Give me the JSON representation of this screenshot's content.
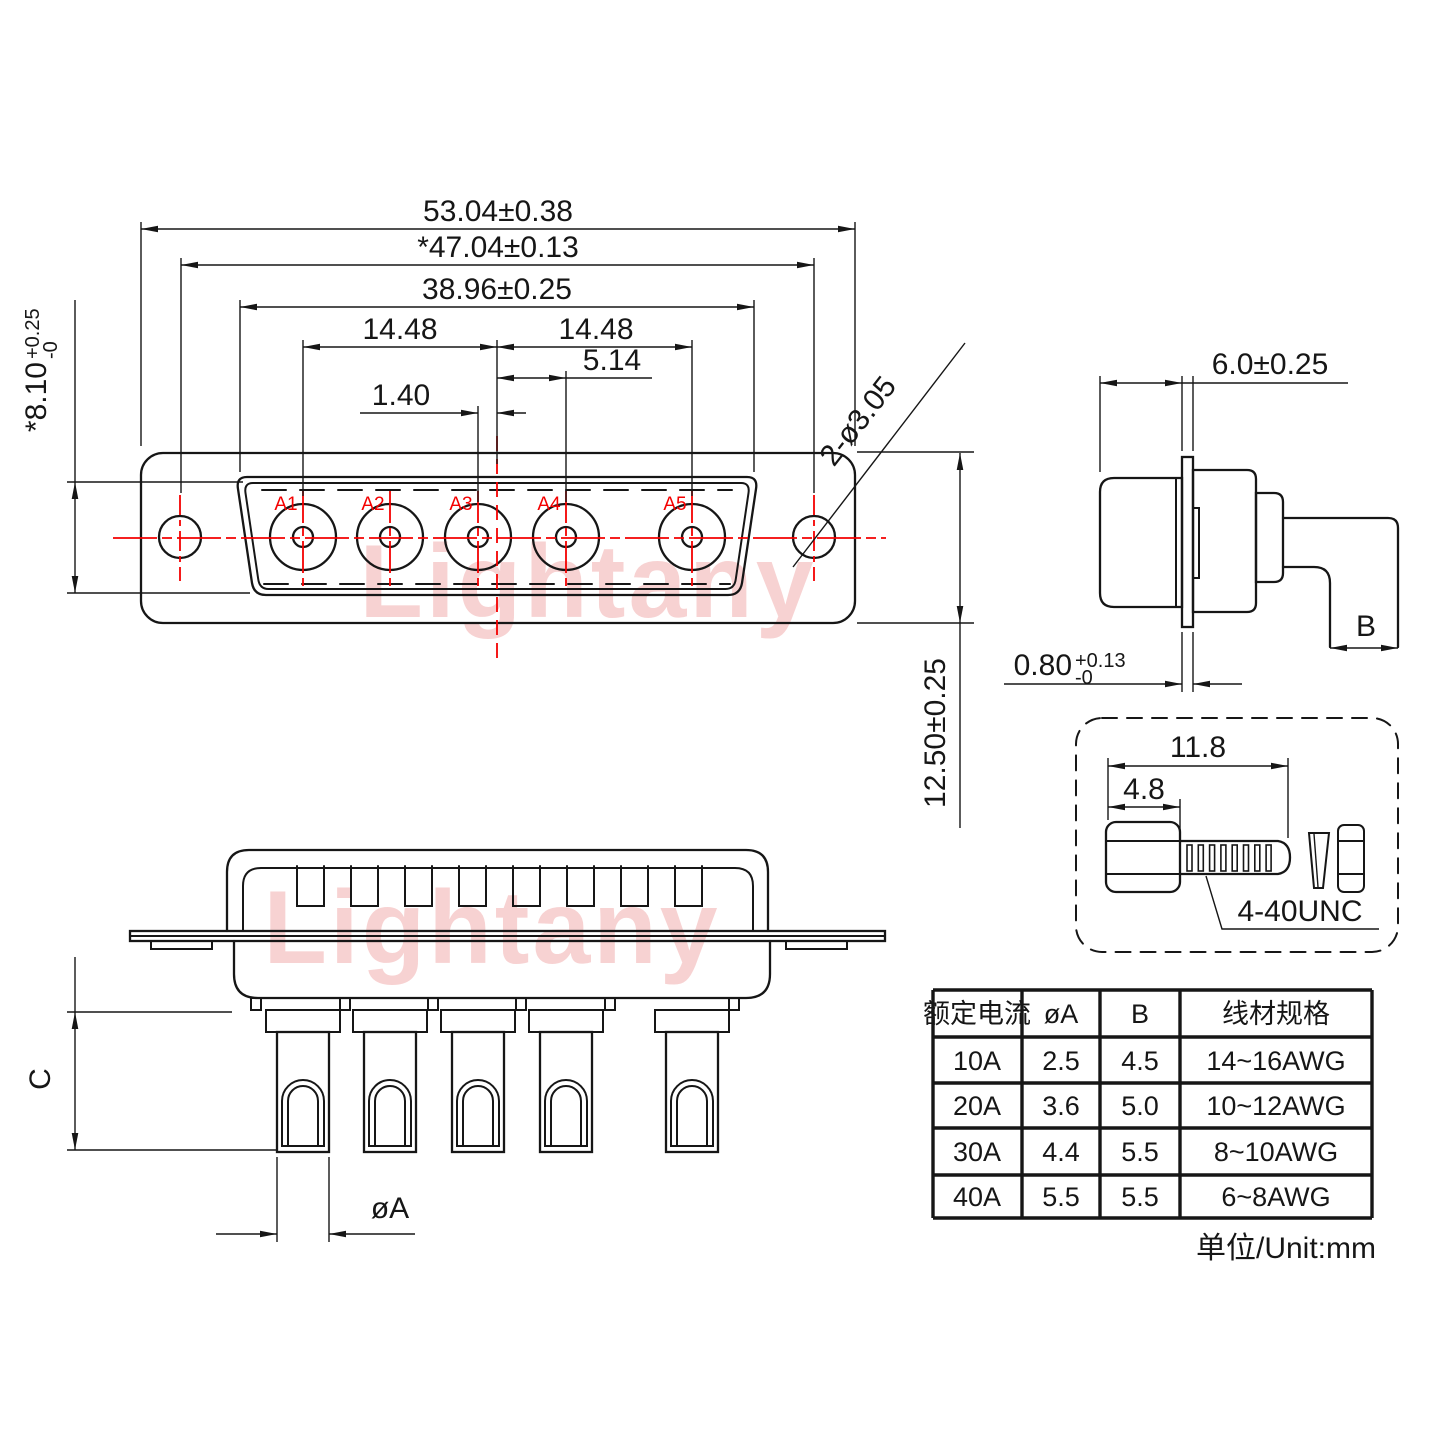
{
  "watermark": {
    "text": "Lightany"
  },
  "front_view": {
    "pin_labels": [
      "A1",
      "A2",
      "A3",
      "A4",
      "A5"
    ],
    "dims": {
      "overall_width": "53.04±0.38",
      "hole_span": "*47.04±0.13",
      "shell_width": "38.96±0.25",
      "pitch_left": "14.48",
      "pitch_right": "14.48",
      "a4_offset": "5.14",
      "a3_offset": "1.40",
      "shell_height_main": "*8.10",
      "shell_height_sup": "+0.25",
      "shell_height_sub": "-0",
      "flange_height": "12.50±0.25",
      "mount_holes": "2-ø3.05"
    }
  },
  "side_view": {
    "dims": {
      "front_depth": "6.0±0.25",
      "plate_main": "0.80",
      "plate_sup": "+0.13",
      "plate_sub": "-0",
      "tail": "B"
    }
  },
  "screw_detail": {
    "dims": {
      "total_len": "11.8",
      "head_len": "4.8"
    },
    "thread_label": "4-40UNC"
  },
  "bottom_view": {
    "dims": {
      "pin_len": "C",
      "pin_dia": "øA"
    }
  },
  "spec_table": {
    "headers": [
      "额定电流",
      "øA",
      "B",
      "线材规格"
    ],
    "rows": [
      [
        "10A",
        "2.5",
        "4.5",
        "14~16AWG"
      ],
      [
        "20A",
        "3.6",
        "5.0",
        "10~12AWG"
      ],
      [
        "30A",
        "4.4",
        "5.5",
        "8~10AWG"
      ],
      [
        "40A",
        "5.5",
        "5.5",
        "6~8AWG"
      ]
    ],
    "unit_note": "单位/Unit:mm"
  }
}
